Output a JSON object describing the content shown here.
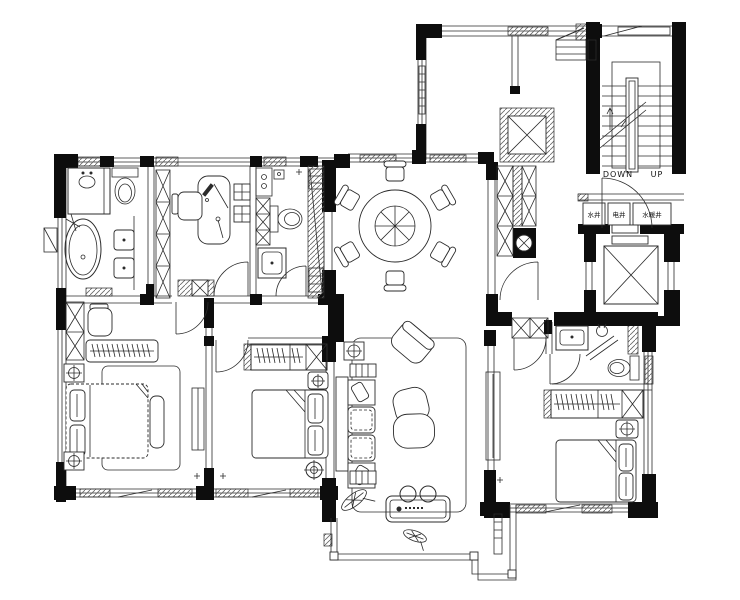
{
  "drawing": {
    "title": "apartment-floor-plan",
    "colors": {
      "background": "#ffffff",
      "lines": "#2b2b2b",
      "walls": "#0d0d0d"
    },
    "stairwell": {
      "down_label": "DOWN",
      "up_label": "UP"
    },
    "utility_shafts": [
      {
        "label": "水井"
      },
      {
        "label": "电井"
      },
      {
        "label": "水暖井"
      }
    ]
  }
}
